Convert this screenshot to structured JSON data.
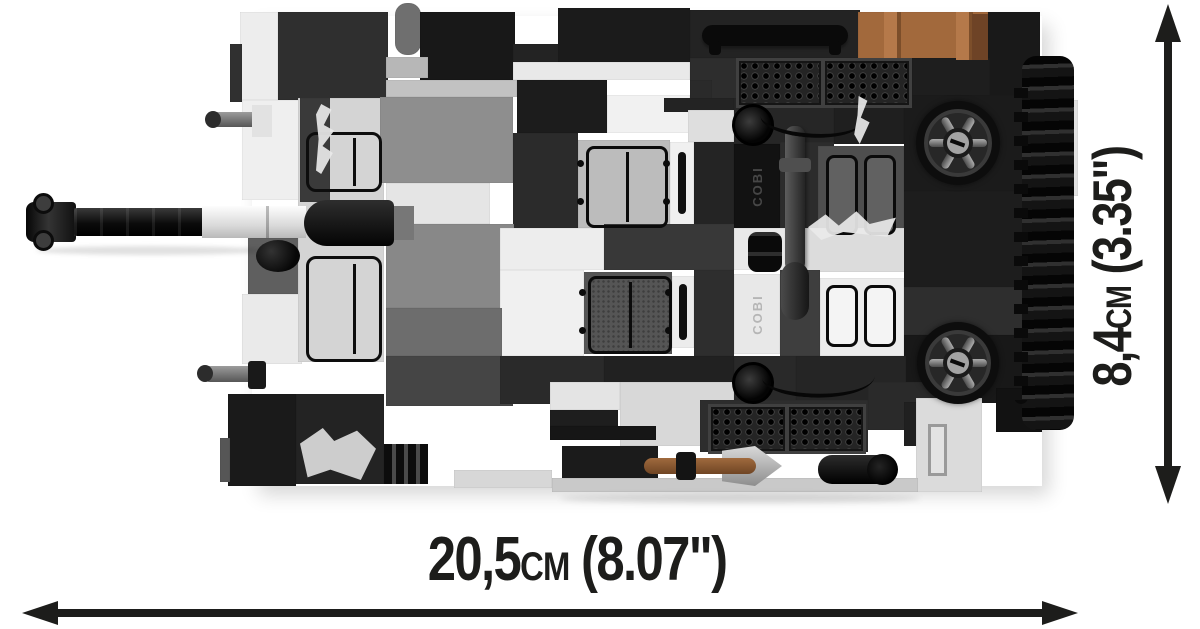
{
  "page": {
    "width": 1200,
    "height": 629,
    "background": "#ffffff"
  },
  "figure": {
    "name": "cobi-brick-tank-top-view",
    "brand_embossing": "COBI",
    "palette": {
      "black": "#141414",
      "dark_grey": "#2d2d2d",
      "grey": "#8e8e8e",
      "light_grey": "#d6d6d6",
      "white": "#efefef",
      "crate_brown": "#a2693c",
      "tool_brown": "#8a5730"
    },
    "blocks": [
      {
        "x": 240,
        "y": 12,
        "w": 38,
        "h": 88,
        "c": "#ededed"
      },
      {
        "x": 278,
        "y": 12,
        "w": 110,
        "h": 88,
        "c": "#2f2f2f"
      },
      {
        "x": 230,
        "y": 44,
        "w": 12,
        "h": 58,
        "c": "#303030"
      },
      {
        "x": 242,
        "y": 100,
        "w": 60,
        "h": 100,
        "c": "#efefef"
      },
      {
        "x": 248,
        "y": 238,
        "w": 58,
        "h": 56,
        "c": "#5f5f5f"
      },
      {
        "x": 242,
        "y": 294,
        "w": 60,
        "h": 70,
        "c": "#eaeaea"
      },
      {
        "x": 298,
        "y": 98,
        "w": 86,
        "h": 264,
        "c": "#d4d4d4"
      },
      {
        "x": 300,
        "y": 98,
        "w": 30,
        "h": 104,
        "c": "#3a3a3a"
      },
      {
        "x": 228,
        "y": 394,
        "w": 68,
        "h": 92,
        "c": "#1a1a1a"
      },
      {
        "x": 220,
        "y": 438,
        "w": 10,
        "h": 44,
        "c": "#565656"
      },
      {
        "x": 296,
        "y": 394,
        "w": 88,
        "h": 90,
        "c": "#232323"
      },
      {
        "x": 395,
        "y": 3,
        "w": 26,
        "h": 52,
        "c": "#6f6f6f",
        "r": 12
      },
      {
        "x": 420,
        "y": 12,
        "w": 95,
        "h": 68,
        "c": "#181818"
      },
      {
        "x": 386,
        "y": 57,
        "w": 42,
        "h": 21,
        "c": "#b7b7b7"
      },
      {
        "x": 513,
        "y": 44,
        "w": 48,
        "h": 18,
        "c": "#232323"
      },
      {
        "x": 558,
        "y": 8,
        "w": 132,
        "h": 54,
        "c": "#1b1b1b"
      },
      {
        "x": 690,
        "y": 10,
        "w": 170,
        "h": 48,
        "c": "#232323"
      },
      {
        "x": 513,
        "y": 62,
        "w": 177,
        "h": 18,
        "c": "#e9e9e9"
      },
      {
        "x": 690,
        "y": 58,
        "w": 222,
        "h": 46,
        "c": "#2d2d2d"
      },
      {
        "x": 858,
        "y": 12,
        "w": 130,
        "h": 48,
        "c": "#a2693c"
      },
      {
        "x": 988,
        "y": 12,
        "w": 52,
        "h": 92,
        "c": "#191919"
      },
      {
        "x": 912,
        "y": 58,
        "w": 78,
        "h": 46,
        "c": "#1e1e1e"
      },
      {
        "x": 386,
        "y": 80,
        "w": 131,
        "h": 17,
        "c": "#c2c2c2"
      },
      {
        "x": 380,
        "y": 97,
        "w": 133,
        "h": 86,
        "c": "#8e8e8e"
      },
      {
        "x": 517,
        "y": 80,
        "w": 90,
        "h": 53,
        "c": "#1c1c1c"
      },
      {
        "x": 607,
        "y": 95,
        "w": 83,
        "h": 38,
        "c": "#f1f1f1"
      },
      {
        "x": 690,
        "y": 80,
        "w": 22,
        "h": 53,
        "c": "#2a2a2a"
      },
      {
        "x": 664,
        "y": 98,
        "w": 70,
        "h": 14,
        "c": "#232323"
      },
      {
        "x": 688,
        "y": 110,
        "w": 46,
        "h": 32,
        "c": "#dedede"
      },
      {
        "x": 734,
        "y": 98,
        "w": 100,
        "h": 46,
        "c": "#262626"
      },
      {
        "x": 834,
        "y": 98,
        "w": 70,
        "h": 46,
        "c": "#1f1f1f"
      },
      {
        "x": 904,
        "y": 95,
        "w": 136,
        "h": 96,
        "c": "#1b1b1b"
      },
      {
        "x": 513,
        "y": 133,
        "w": 65,
        "h": 95,
        "c": "#2b2b2b"
      },
      {
        "x": 578,
        "y": 140,
        "w": 92,
        "h": 88,
        "c": "#bcbcbc"
      },
      {
        "x": 670,
        "y": 142,
        "w": 24,
        "h": 84,
        "c": "#f0f0f0"
      },
      {
        "x": 694,
        "y": 142,
        "w": 40,
        "h": 86,
        "c": "#242424"
      },
      {
        "x": 734,
        "y": 144,
        "w": 46,
        "h": 84,
        "c": "#121212"
      },
      {
        "x": 780,
        "y": 142,
        "w": 54,
        "h": 86,
        "c": "#2c2c2c"
      },
      {
        "x": 818,
        "y": 146,
        "w": 86,
        "h": 100,
        "c": "#4e4e4e"
      },
      {
        "x": 386,
        "y": 183,
        "w": 104,
        "h": 41,
        "c": "#e5e5e5"
      },
      {
        "x": 386,
        "y": 224,
        "w": 128,
        "h": 84,
        "c": "#888888"
      },
      {
        "x": 500,
        "y": 228,
        "w": 104,
        "h": 42,
        "c": "#ededed"
      },
      {
        "x": 604,
        "y": 224,
        "w": 130,
        "h": 46,
        "c": "#383838"
      },
      {
        "x": 734,
        "y": 228,
        "w": 62,
        "h": 42,
        "c": "#e9e9e9"
      },
      {
        "x": 796,
        "y": 228,
        "w": 110,
        "h": 44,
        "c": "#dcdcdc"
      },
      {
        "x": 500,
        "y": 270,
        "w": 84,
        "h": 86,
        "c": "#f0f0f0"
      },
      {
        "x": 584,
        "y": 272,
        "w": 88,
        "h": 82,
        "c": "#555555"
      },
      {
        "x": 672,
        "y": 276,
        "w": 22,
        "h": 72,
        "c": "#ececec"
      },
      {
        "x": 694,
        "y": 270,
        "w": 40,
        "h": 86,
        "c": "#2e2e2e"
      },
      {
        "x": 734,
        "y": 274,
        "w": 46,
        "h": 80,
        "c": "#e8e8e8"
      },
      {
        "x": 780,
        "y": 270,
        "w": 40,
        "h": 86,
        "c": "#3e3e3e"
      },
      {
        "x": 820,
        "y": 278,
        "w": 84,
        "h": 78,
        "c": "#ececec"
      },
      {
        "x": 904,
        "y": 191,
        "w": 136,
        "h": 96,
        "c": "#1d1d1d"
      },
      {
        "x": 904,
        "y": 287,
        "w": 124,
        "h": 48,
        "c": "#2e2e2e"
      },
      {
        "x": 904,
        "y": 335,
        "w": 136,
        "h": 68,
        "c": "#181818"
      },
      {
        "x": 386,
        "y": 308,
        "w": 116,
        "h": 48,
        "c": "#6d6d6d"
      },
      {
        "x": 386,
        "y": 356,
        "w": 127,
        "h": 50,
        "c": "#454545"
      },
      {
        "x": 500,
        "y": 356,
        "w": 104,
        "h": 48,
        "c": "#2a2a2a"
      },
      {
        "x": 604,
        "y": 356,
        "w": 130,
        "h": 48,
        "c": "#212121"
      },
      {
        "x": 734,
        "y": 356,
        "w": 62,
        "h": 46,
        "c": "#292929"
      },
      {
        "x": 796,
        "y": 356,
        "w": 110,
        "h": 46,
        "c": "#252525"
      },
      {
        "x": 550,
        "y": 382,
        "w": 70,
        "h": 28,
        "c": "#e4e4e4"
      },
      {
        "x": 620,
        "y": 382,
        "w": 114,
        "h": 64,
        "c": "#d8d8d8"
      },
      {
        "x": 550,
        "y": 410,
        "w": 68,
        "h": 16,
        "c": "#1e1e1e"
      },
      {
        "x": 550,
        "y": 426,
        "w": 106,
        "h": 14,
        "c": "#161616"
      },
      {
        "x": 562,
        "y": 446,
        "w": 96,
        "h": 32,
        "c": "#1b1b1b"
      },
      {
        "x": 700,
        "y": 400,
        "w": 168,
        "h": 52,
        "c": "#2d2d2d"
      },
      {
        "x": 868,
        "y": 382,
        "w": 80,
        "h": 48,
        "c": "#2a2a2a"
      },
      {
        "x": 904,
        "y": 402,
        "w": 54,
        "h": 44,
        "c": "#202020"
      },
      {
        "x": 916,
        "y": 398,
        "w": 66,
        "h": 94,
        "c": "#dbdbdb"
      },
      {
        "x": 454,
        "y": 470,
        "w": 98,
        "h": 18,
        "c": "#d7d7d7"
      },
      {
        "x": 552,
        "y": 478,
        "w": 366,
        "h": 14,
        "c": "#c9c9c9"
      },
      {
        "x": 1028,
        "y": 100,
        "w": 50,
        "h": 96,
        "c": "#e2e2e2"
      },
      {
        "x": 996,
        "y": 388,
        "w": 46,
        "h": 44,
        "c": "#121212"
      }
    ]
  },
  "dimensions": {
    "color": "#1d1d1b",
    "width": {
      "value": "20,5",
      "unit": "cm",
      "imperial": "(8.07\")"
    },
    "height": {
      "value": "8,4",
      "unit": "cm",
      "imperial": "(3.35\")"
    }
  }
}
